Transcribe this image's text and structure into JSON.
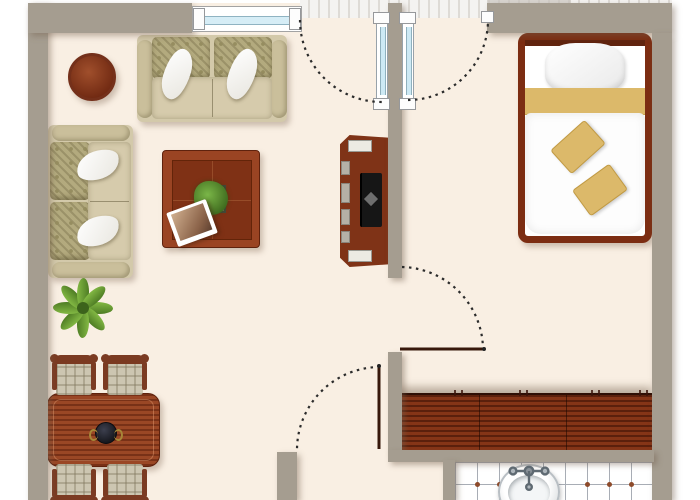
{
  "scene": {
    "type": "floor-plan",
    "description": "Top-down architectural floor plan of a studio apartment with living/dining area, bedroom corner, kitchen counter and bathroom",
    "rooms": [
      {
        "id": "living-dining",
        "label": "Living / dining area",
        "furniture": [
          "two-seat sofa (top wall)",
          "two-seat sofa (left wall)",
          "coffee table with plant and photo",
          "round side table",
          "potted plant",
          "dining table with centerpiece bowl",
          "four plaid dining chairs",
          "TV cabinet"
        ]
      },
      {
        "id": "bedroom-hall",
        "label": "Bedroom and entry hall",
        "furniture": [
          "double bed with gold accent pillows"
        ]
      },
      {
        "id": "kitchen",
        "label": "Kitchen nook",
        "furniture": [
          "wood kitchen counter with cabinet handles"
        ]
      },
      {
        "id": "bathroom",
        "label": "Bathroom",
        "furniture": [
          "oval sink with chrome faucet",
          "white tiled floor with accent dots"
        ]
      }
    ],
    "openings": [
      {
        "id": "window-top",
        "label": "Window (top wall)"
      },
      {
        "id": "glass-door-left",
        "label": "Glass door leaf swinging into living room"
      },
      {
        "id": "glass-door-right",
        "label": "Glass door leaf swinging into hall"
      },
      {
        "id": "hall-door",
        "label": "Interior door between living room and hall"
      },
      {
        "id": "lower-door",
        "label": "Interior door at lower hall"
      }
    ]
  },
  "furniture": {
    "bed": {
      "label": "Double bed"
    },
    "sofa_top": {
      "label": "Two-seat sofa"
    },
    "sofa_left": {
      "label": "Two-seat sofa"
    },
    "coffee_table": {
      "label": "Coffee table with plant and photo"
    },
    "side_table": {
      "label": "Round side table"
    },
    "plant": {
      "label": "Potted plant"
    },
    "dining_table": {
      "label": "Dining table with centerpiece bowl"
    },
    "chair": {
      "label": "Dining chair"
    },
    "tv_unit": {
      "label": "TV cabinet"
    },
    "counter": {
      "label": "Kitchen counter"
    },
    "sink": {
      "label": "Bathroom sink"
    },
    "tiles": {
      "label": "Bathroom tiled floor"
    },
    "window": {
      "label": "Window"
    },
    "door_glass_left": {
      "label": "Glass entry door (left leaf)"
    },
    "door_glass_right": {
      "label": "Glass entry door (right leaf)"
    },
    "wall": {
      "label": "Wall"
    }
  },
  "colors": {
    "wall": "#a59d90",
    "floor": "#f9efe3",
    "wood_dark": "#7c2d12",
    "wood_mid": "#8f3c1d",
    "sofa_beige": "#d3c9aa",
    "accent_gold": "#dcb96a",
    "glass_blue": "#cde9f4",
    "plant_green": "#6fa83a",
    "tile_dot": "#8d4a2a"
  }
}
